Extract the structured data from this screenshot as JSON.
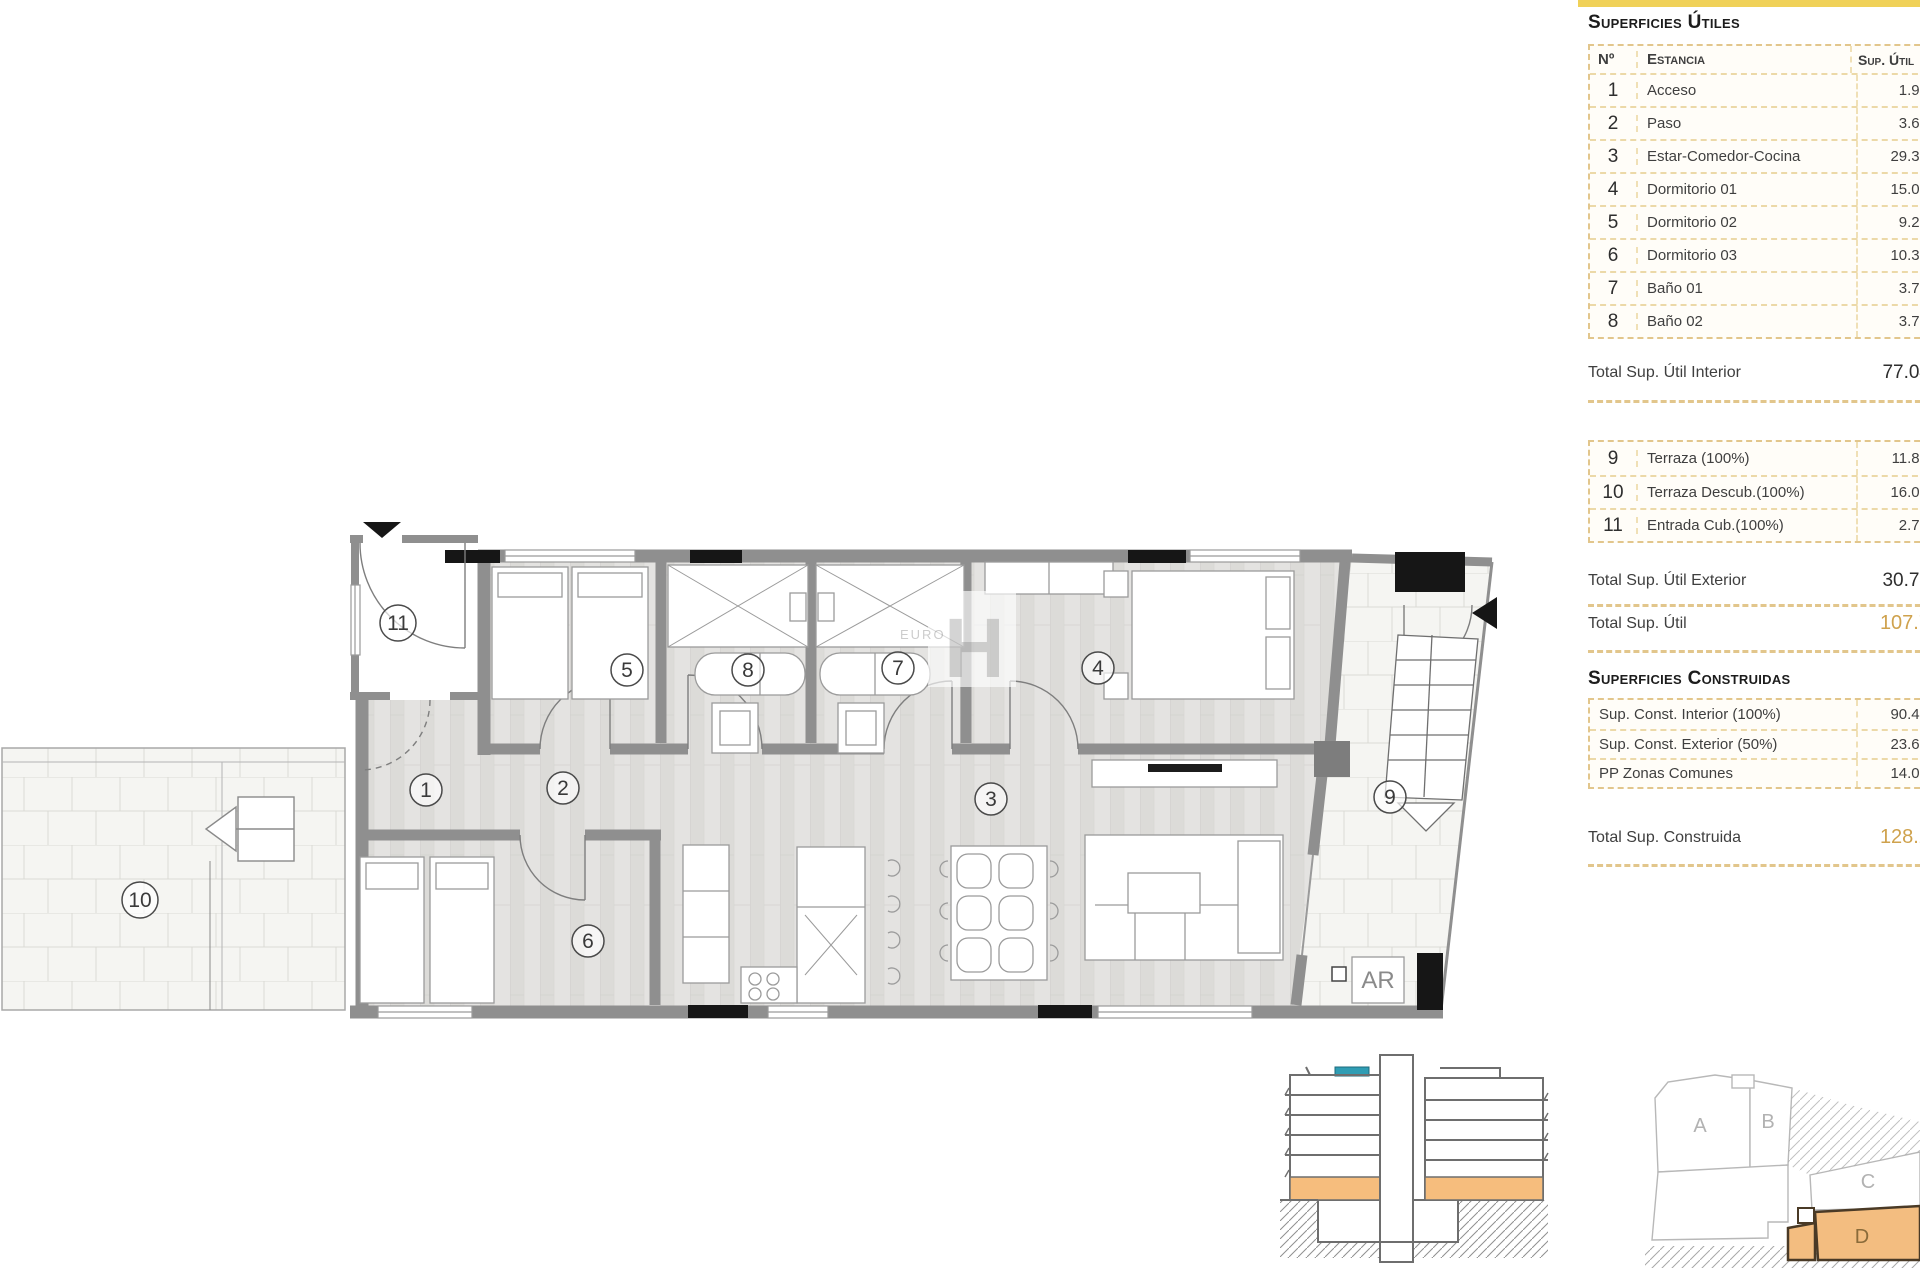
{
  "colors": {
    "accent_yellow": "#f0d158",
    "accent_gold": "#cfa24d",
    "wall_gray": "#8f8f8f",
    "highlight_orange": "#f6bd7d",
    "highlight_teal": "#2f9db4"
  },
  "surfaces_utiles": {
    "title": "Superficies Útiles",
    "columns": {
      "num": "Nº",
      "room": "Estancia",
      "sup": "Sup. Útil"
    },
    "rows": [
      {
        "num": "1",
        "name": "Acceso",
        "value": "1.94"
      },
      {
        "num": "2",
        "name": "Paso",
        "value": "3.67"
      },
      {
        "num": "3",
        "name": "Estar-Comedor-Cocina",
        "value": "29.39"
      },
      {
        "num": "4",
        "name": "Dormitorio 01",
        "value": "15.03"
      },
      {
        "num": "5",
        "name": "Dormitorio 02",
        "value": "9.29"
      },
      {
        "num": "6",
        "name": "Dormitorio 03",
        "value": "10.30"
      },
      {
        "num": "7",
        "name": "Baño 01",
        "value": "3.71"
      },
      {
        "num": "8",
        "name": "Baño 02",
        "value": "3.71"
      }
    ],
    "total_interior": {
      "label": "Total Sup. Útil Interior",
      "value": "77.04"
    },
    "exterior_rows": [
      {
        "num": "9",
        "name": "Terraza (100%)",
        "value": "11.88"
      },
      {
        "num": "10",
        "name": "Terraza Descub.(100%)",
        "value": "16.08"
      },
      {
        "num": "11",
        "name": "Entrada Cub.(100%)",
        "value": "2.76"
      }
    ],
    "total_exterior": {
      "label": "Total Sup. Útil Exterior",
      "value": "30.72"
    },
    "total_util": {
      "label": "Total Sup. Útil",
      "value": "107.7"
    }
  },
  "surfaces_construidas": {
    "title": "Superficies Construidas",
    "rows": [
      {
        "label": "Sup. Const. Interior (100%)",
        "value": "90.48"
      },
      {
        "label": "Sup. Const. Exterior (50%)",
        "value": "23.68"
      },
      {
        "label": "PP Zonas Comunes",
        "value": "14.05"
      }
    ],
    "total": {
      "label": "Total Sup. Construida",
      "value": "128.2"
    }
  },
  "floor_plan": {
    "room_labels": [
      "1",
      "2",
      "3",
      "4",
      "5",
      "6",
      "7",
      "8",
      "9",
      "10",
      "11"
    ],
    "ar_label": "AR",
    "watermark": {
      "small": "EURO",
      "big": "H"
    }
  },
  "site_plan": {
    "blocks": [
      "A",
      "B",
      "C",
      "D"
    ]
  }
}
